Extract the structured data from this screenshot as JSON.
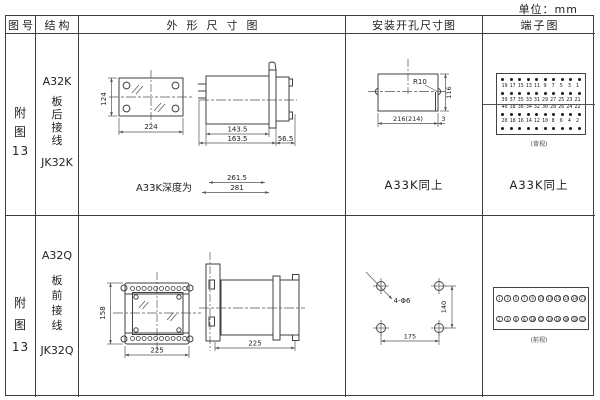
{
  "unit_label": "单位：mm",
  "headers": {
    "col1": "图号",
    "col2": "结构",
    "col3": "外形尺寸图",
    "col4": "安装开孔尺寸图",
    "col5": "端子图"
  },
  "row1": {
    "figure_no": {
      "l1": "附",
      "l2": "图",
      "l3": "13"
    },
    "structure": {
      "l1": "A32K",
      "l2": "板",
      "l3": "后",
      "l4": "接",
      "l5": "线",
      "l6": "JK32K"
    },
    "outline": {
      "front_height": "124",
      "front_width": "224",
      "side_d1": "143.5",
      "side_d2": "163.5",
      "side_d3": "56.5",
      "depth_caption": "A33K深度为",
      "depth_d1": "261.5",
      "depth_d2": "281"
    },
    "mounting": {
      "radius": "R10",
      "height": "116",
      "width": "216(214)",
      "slot": "3",
      "note": "A33K同上"
    },
    "terminal": {
      "note": "A33K同上",
      "view": "(背视)",
      "num_rows": [
        [
          "19",
          "17",
          "15",
          "13",
          "11",
          "9",
          "7",
          "5",
          "3",
          "1"
        ],
        [
          "39",
          "37",
          "35",
          "33",
          "31",
          "29",
          "27",
          "25",
          "23",
          "21"
        ],
        [
          "40",
          "38",
          "36",
          "34",
          "32",
          "30",
          "28",
          "26",
          "24",
          "22"
        ],
        [
          "20",
          "18",
          "16",
          "14",
          "12",
          "10",
          "8",
          "6",
          "4",
          "2"
        ]
      ]
    }
  },
  "row2": {
    "figure_no": {
      "l1": "附",
      "l2": "图",
      "l3": "13"
    },
    "structure": {
      "l1": "A32Q",
      "l2": "板",
      "l3": "前",
      "l4": "接",
      "l5": "线",
      "l6": "JK32Q"
    },
    "outline": {
      "front_height": "158",
      "front_width": "225",
      "side_width": "225"
    },
    "mounting": {
      "holes": "4-Φ6",
      "height": "140",
      "width": "175"
    },
    "terminal": {
      "view": "(前视)",
      "top": [
        "1",
        "3",
        "5",
        "7",
        "9",
        "11",
        "13",
        "15",
        "17",
        "19",
        "21"
      ],
      "bottom": [
        "2",
        "4",
        "6",
        "8",
        "10",
        "12",
        "14",
        "16",
        "18",
        "20",
        "22"
      ]
    }
  }
}
